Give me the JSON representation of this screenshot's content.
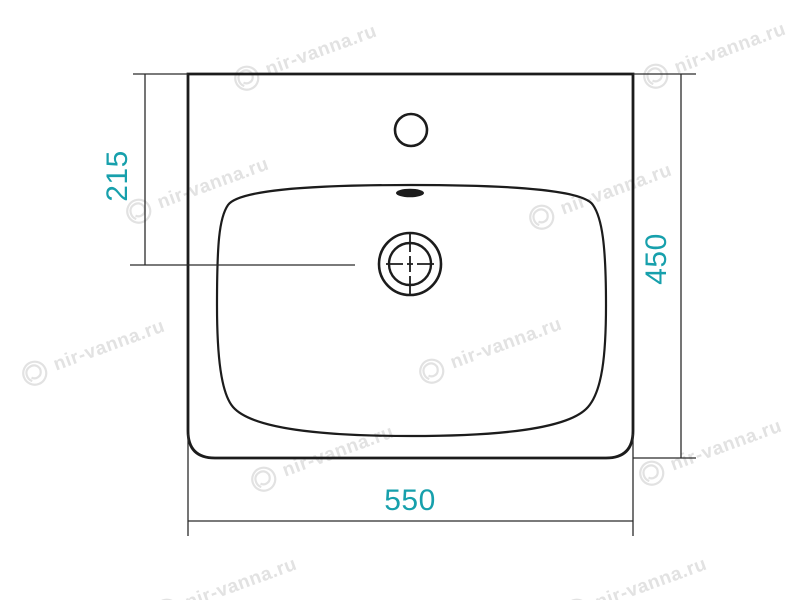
{
  "watermark": {
    "text": "nir-vanna.ru"
  },
  "dimension_labels": {
    "left_vertical": "215",
    "right_vertical": "450",
    "bottom_horizontal": "550"
  },
  "colors": {
    "dimension_text": "#17a0ac",
    "outline": "#1c1c1c",
    "dimension_line": "#2b2b2b",
    "watermark": "#e2e2e2"
  }
}
